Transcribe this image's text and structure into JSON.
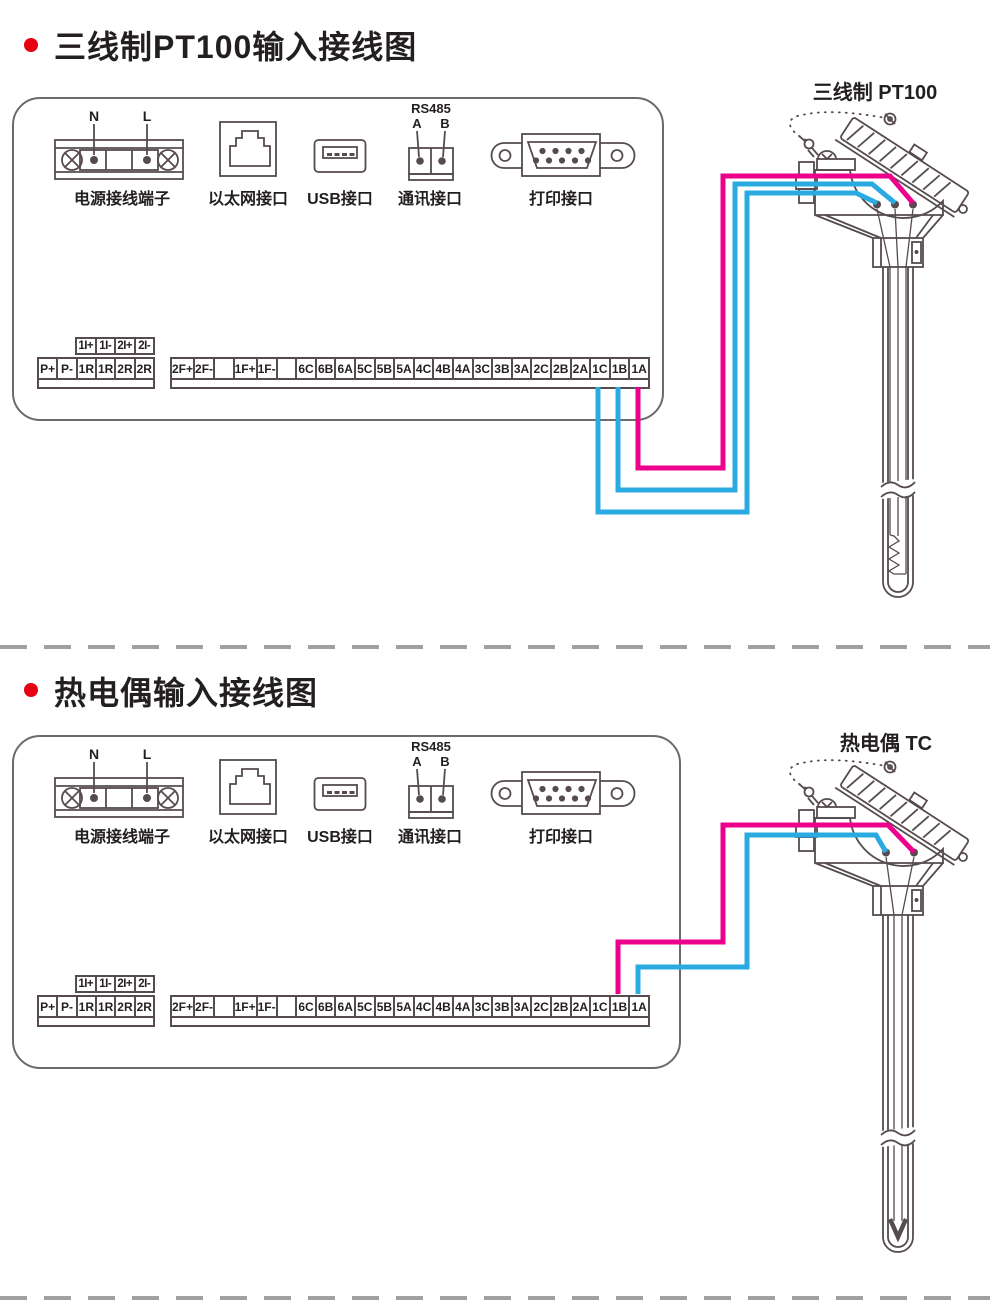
{
  "colors": {
    "line": "#564b4e",
    "text": "#231f20",
    "magenta": "#ec008c",
    "blue": "#29abe2",
    "bullet": "#e60012",
    "dash": "#9fa0a0",
    "panel_border": "#6a6b6d"
  },
  "sections": [
    {
      "title": "三线制PT100输入接线图",
      "sensor_label": "三线制 PT100",
      "sensor_type": "rtd-3wire",
      "ports": {
        "power": {
          "caption": "电源接线端子",
          "n": "N",
          "l": "L"
        },
        "ethernet": {
          "caption": "以太网接口"
        },
        "usb": {
          "caption": "USB接口"
        },
        "comm": {
          "caption": "通讯接口",
          "bus": "RS485",
          "a": "A",
          "b": "B"
        },
        "printer": {
          "caption": "打印接口"
        }
      },
      "terminals": {
        "aux": [
          "1I+",
          "1I-",
          "2I+",
          "2I-"
        ],
        "left": [
          "P+",
          "P-",
          "1R",
          "1R",
          "2R",
          "2R"
        ],
        "right": [
          "2F+",
          "2F-",
          "",
          "1F+",
          "1F-",
          "",
          "6C",
          "6B",
          "6A",
          "5C",
          "5B",
          "5A",
          "4C",
          "4B",
          "4A",
          "3C",
          "3B",
          "3A",
          "2C",
          "2B",
          "2A",
          "1C",
          "1B",
          "1A"
        ]
      },
      "wires": [
        {
          "terminal": "1A",
          "color": "magenta"
        },
        {
          "terminal": "1B",
          "color": "blue"
        },
        {
          "terminal": "1C",
          "color": "blue"
        }
      ]
    },
    {
      "title": "热电偶输入接线图",
      "sensor_label": "热电偶 TC",
      "sensor_type": "thermocouple",
      "ports": {
        "power": {
          "caption": "电源接线端子",
          "n": "N",
          "l": "L"
        },
        "ethernet": {
          "caption": "以太网接口"
        },
        "usb": {
          "caption": "USB接口"
        },
        "comm": {
          "caption": "通讯接口",
          "bus": "RS485",
          "a": "A",
          "b": "B"
        },
        "printer": {
          "caption": "打印接口"
        }
      },
      "terminals": {
        "aux": [
          "1I+",
          "1I-",
          "2I+",
          "2I-"
        ],
        "left": [
          "P+",
          "P-",
          "1R",
          "1R",
          "2R",
          "2R"
        ],
        "right": [
          "2F+",
          "2F-",
          "",
          "1F+",
          "1F-",
          "",
          "6C",
          "6B",
          "6A",
          "5C",
          "5B",
          "5A",
          "4C",
          "4B",
          "4A",
          "3C",
          "3B",
          "3A",
          "2C",
          "2B",
          "2A",
          "1C",
          "1B",
          "1A"
        ]
      },
      "wires": [
        {
          "terminal": "1B",
          "color": "magenta"
        },
        {
          "terminal": "1A",
          "color": "blue"
        }
      ]
    }
  ]
}
